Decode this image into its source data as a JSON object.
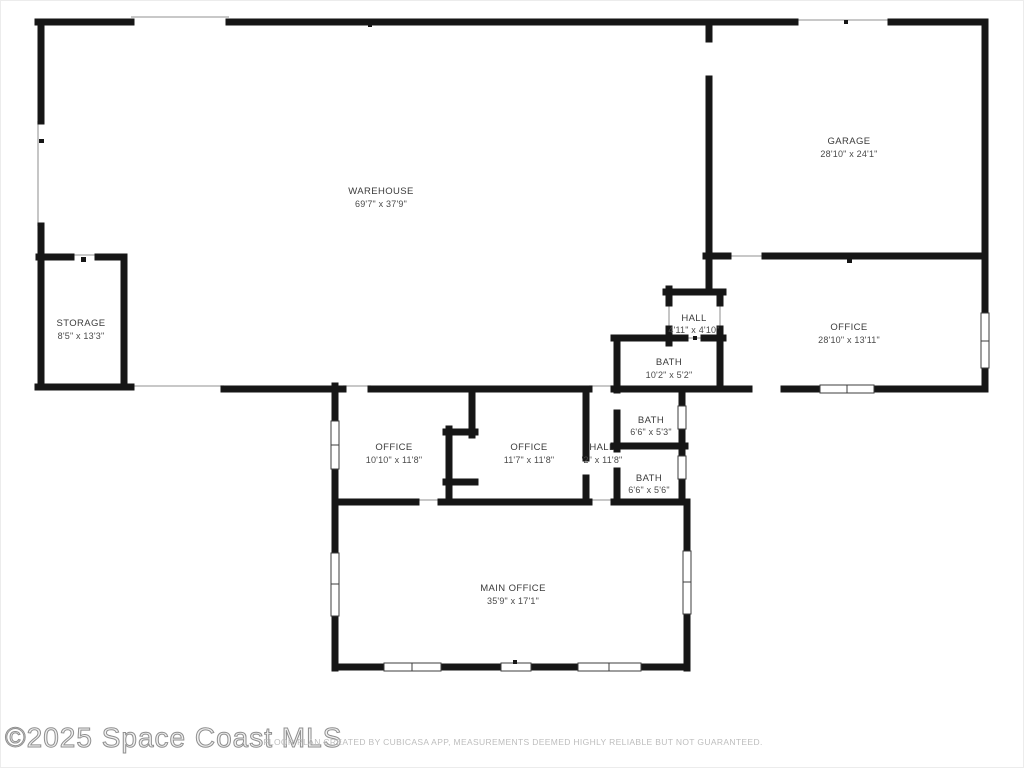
{
  "floor_plan": {
    "rooms": {
      "warehouse": {
        "name": "WAREHOUSE",
        "dims": "69'7\" x 37'9\""
      },
      "garage": {
        "name": "GARAGE",
        "dims": "28'10\" x 24'1\""
      },
      "storage": {
        "name": "STORAGE",
        "dims": "8'5\" x 13'3\""
      },
      "office_right": {
        "name": "OFFICE",
        "dims": "28'10\" x 13'11\""
      },
      "hall_upper": {
        "name": "HALL",
        "dims": "4'11\" x 4'10\""
      },
      "bath_large": {
        "name": "BATH",
        "dims": "10'2\" x 5'2\""
      },
      "bath_mid": {
        "name": "BATH",
        "dims": "6'6\" x 5'3\""
      },
      "bath_lower": {
        "name": "BATH",
        "dims": "6'6\" x 5'6\""
      },
      "office_left": {
        "name": "OFFICE",
        "dims": "10'10\" x 11'8\""
      },
      "office_center": {
        "name": "OFFICE",
        "dims": "11'7\" x 11'8\""
      },
      "hall_corridor": {
        "name": "HALL",
        "dims": "'2\" x 11'8\""
      },
      "main_office": {
        "name": "MAIN OFFICE",
        "dims": "35'9\" x 17'1\""
      }
    },
    "footer": {
      "watermark": "©2025 Space Coast MLS",
      "disclaimer": "FLOOR PLAN CREATED BY CUBICASA APP, MEASUREMENTS DEEMED HIGHLY RELIABLE BUT NOT GUARANTEED."
    },
    "colors": {
      "wall": "#161616",
      "opening_line": "#a8a8a8",
      "label_text": "#3b3b3b",
      "watermark_text": "#8f8f8f",
      "disclaimer_text": "#bdbdbd",
      "background": "#ffffff"
    }
  }
}
